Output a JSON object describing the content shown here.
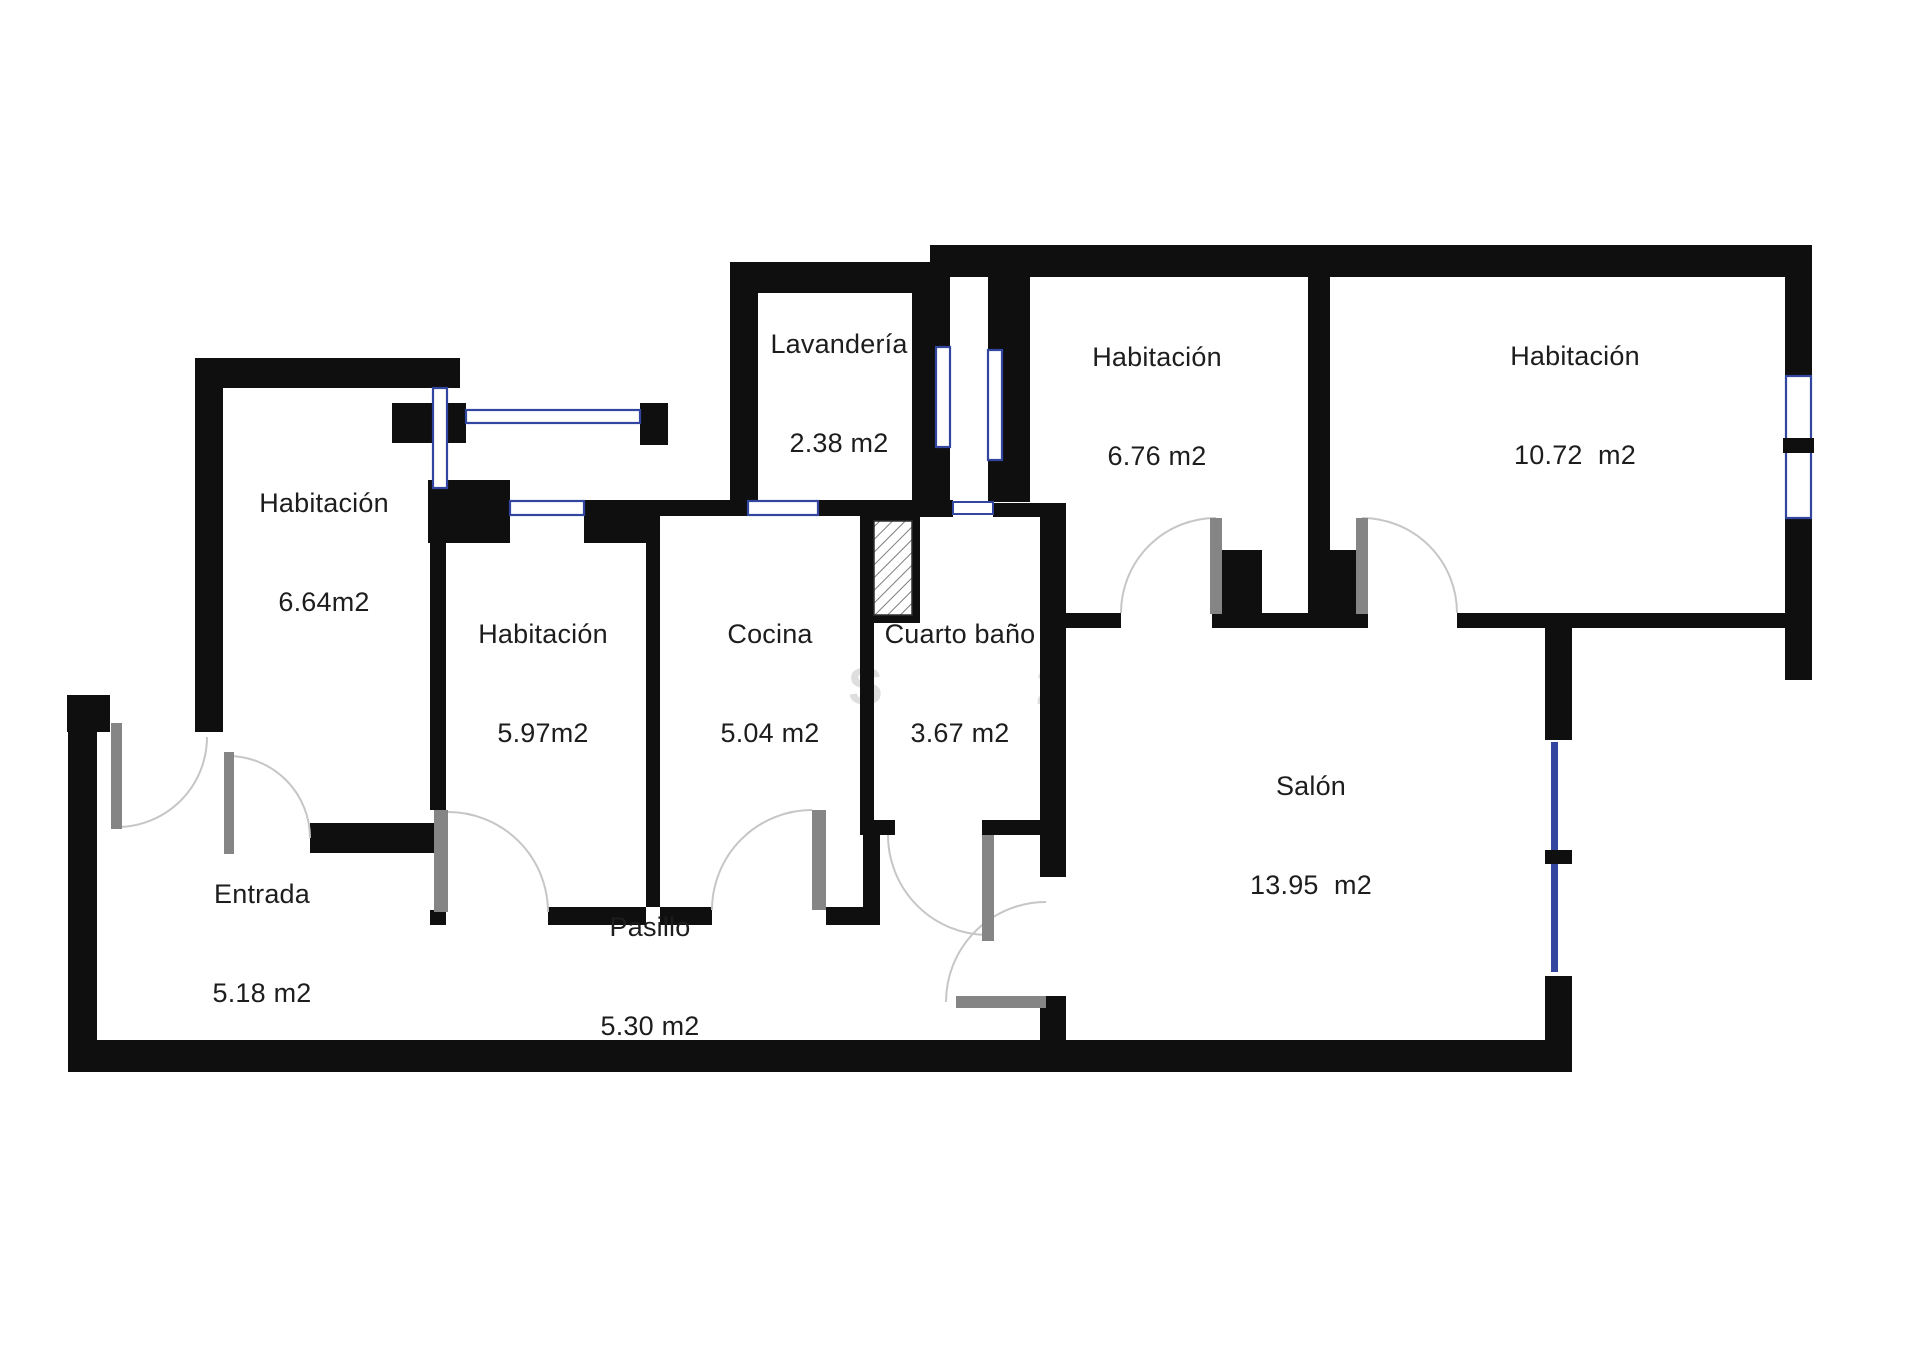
{
  "document": {
    "type": "floor-plan",
    "language": "es"
  },
  "rooms": [
    {
      "id": "habitacion-664",
      "name": "Habitación",
      "area": "6.64m2"
    },
    {
      "id": "lavanderia",
      "name": "Lavandería",
      "area": "2.38 m2"
    },
    {
      "id": "habitacion-676",
      "name": "Habitación",
      "area": "6.76 m2"
    },
    {
      "id": "habitacion-1072",
      "name": "Habitación",
      "area": "10.72  m2"
    },
    {
      "id": "habitacion-597",
      "name": "Habitación",
      "area": "5.97m2"
    },
    {
      "id": "cocina",
      "name": "Cocina",
      "area": "5.04 m2"
    },
    {
      "id": "cuarto-bano",
      "name": "Cuarto baño",
      "area": "3.67 m2"
    },
    {
      "id": "salon",
      "name": "Salón",
      "area": "13.95  m2"
    },
    {
      "id": "entrada",
      "name": "Entrada",
      "area": "5.18 m2"
    },
    {
      "id": "pasillo",
      "name": "Pasillo",
      "area": "5.30 m2"
    }
  ],
  "watermark": [
    "S",
    "2"
  ],
  "colors": {
    "wall": "#0f0f0f",
    "window_blue": "#32459f",
    "door_leaf": "#858585",
    "door_arc": "#c6c6c6",
    "label_text": "#1d1d1d",
    "watermark": "#dedede",
    "background": "#ffffff"
  }
}
